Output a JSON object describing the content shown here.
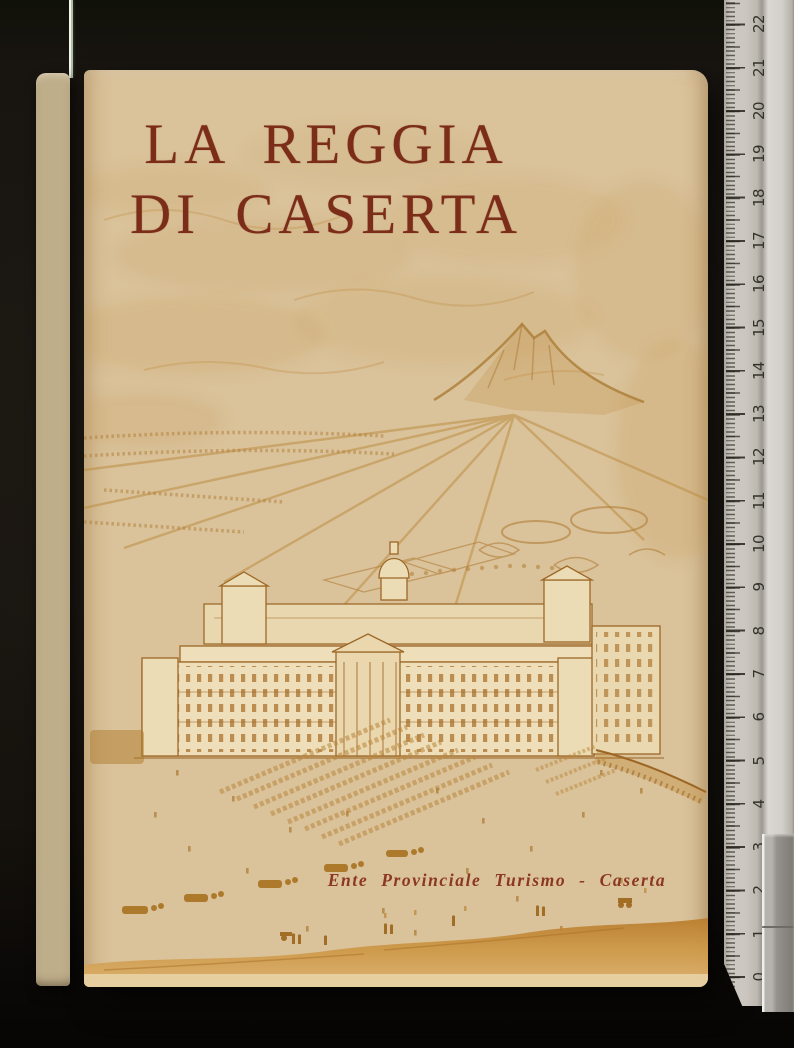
{
  "book": {
    "title_line1": "LA REGGIA",
    "title_line2": "DI CASERTA",
    "imprint": "Ente Provinciale Turismo - Caserta",
    "cover_illustration": "bird's-eye engraving of the Royal Palace of Caserta with gardens, avenues, parade grounds and mountain"
  },
  "ruler": {
    "numbers": [
      "0",
      "1",
      "2",
      "3",
      "4",
      "5",
      "6",
      "7",
      "8",
      "9",
      "10",
      "11",
      "12",
      "13",
      "14",
      "15",
      "16",
      "17",
      "18",
      "19",
      "20",
      "21",
      "22"
    ]
  },
  "colors": {
    "cover_cream": "#dac29a",
    "title_red": "#7c2d19",
    "imprint_red": "#8c3721",
    "engraving_ochre": "#c08a3c",
    "background_black": "#17130e",
    "ruler_gray": "#c9c5be"
  }
}
